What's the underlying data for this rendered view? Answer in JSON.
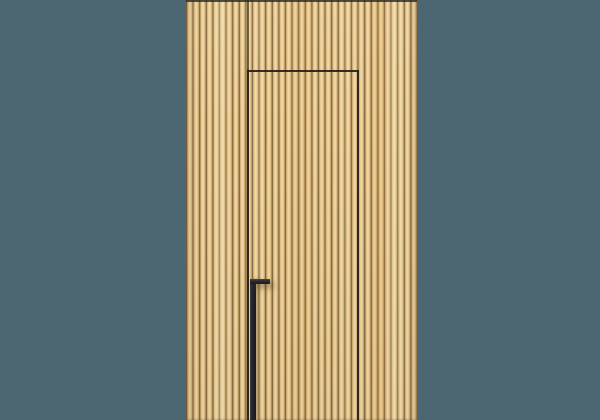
{
  "scene": {
    "description": "Concealed flush door integrated into a vertical wood slat wall panel, with a black L-shaped recessed pull handle, rendered on a plain slate-teal backdrop",
    "elements": {
      "backdrop": "plain slate-teal background",
      "wall": "full-height light oak vertical slat panel",
      "door": "hidden door outlined by thin dark gap lines, slats continue across its face",
      "handle": "matte black L-shaped pull, vertical bar running from mid-height to floor with a short horizontal top piece"
    },
    "colors": {
      "bg": "#4c6771",
      "wood-light": "#f1dba9",
      "wood-mid": "#dcba7f",
      "wood-gap": "#8a6c42",
      "seam": "#282218",
      "handle": "#232327"
    }
  }
}
